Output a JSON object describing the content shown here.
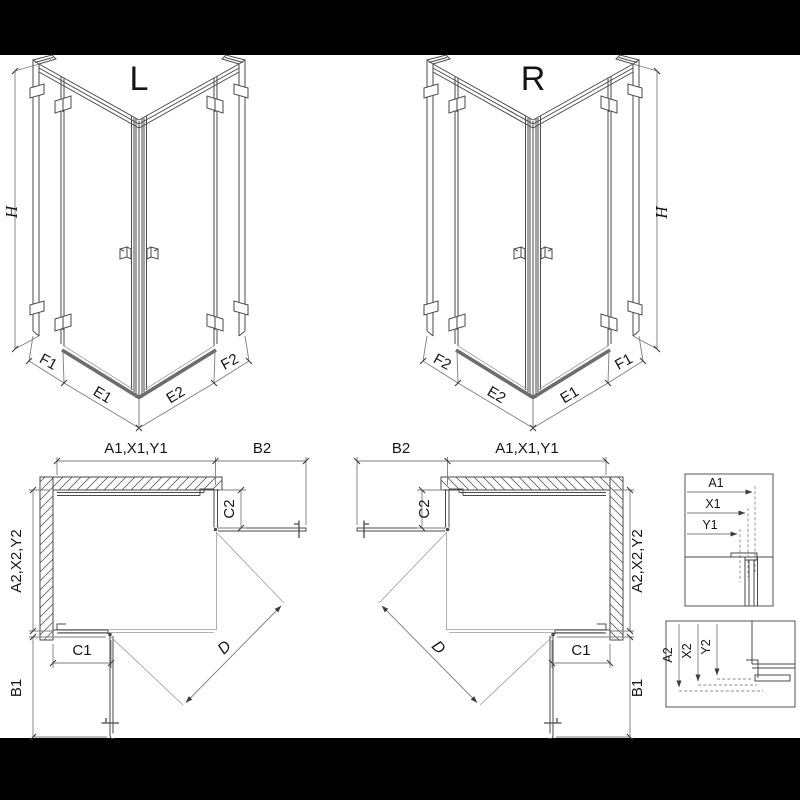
{
  "drawing": {
    "iso_left": {
      "view_label": "L",
      "height_dim": "H",
      "dims": {
        "f1": "F1",
        "e1": "E1",
        "e2": "E2",
        "f2": "F2"
      }
    },
    "iso_right": {
      "view_label": "R",
      "height_dim": "H",
      "dims": {
        "f2": "F2",
        "e2": "E2",
        "e1": "E1",
        "f1": "F1"
      }
    },
    "plan_left": {
      "width_dim": "A1,X1,Y1",
      "door_front_dim": "B2",
      "fixed_front_dim": "C2",
      "depth_dim": "A2,X2,Y2",
      "door_side_dim": "B1",
      "fixed_side_dim": "C1",
      "diagonal_dim": "D"
    },
    "plan_right": {
      "width_dim": "A1,X1,Y1",
      "door_front_dim": "B2",
      "fixed_front_dim": "C2",
      "depth_dim": "A2,X2,Y2",
      "door_side_dim": "B1",
      "fixed_side_dim": "C1",
      "diagonal_dim": "D"
    },
    "detail_width": {
      "dims": [
        "A1",
        "X1",
        "Y1"
      ]
    },
    "detail_depth": {
      "dims": [
        "A2",
        "X2",
        "Y2"
      ]
    },
    "colors": {
      "line": "#4a4a4a",
      "dim_line": "#7d7d7d",
      "text": "#151515",
      "background": "#ffffff",
      "letterbox": "#000000"
    }
  }
}
